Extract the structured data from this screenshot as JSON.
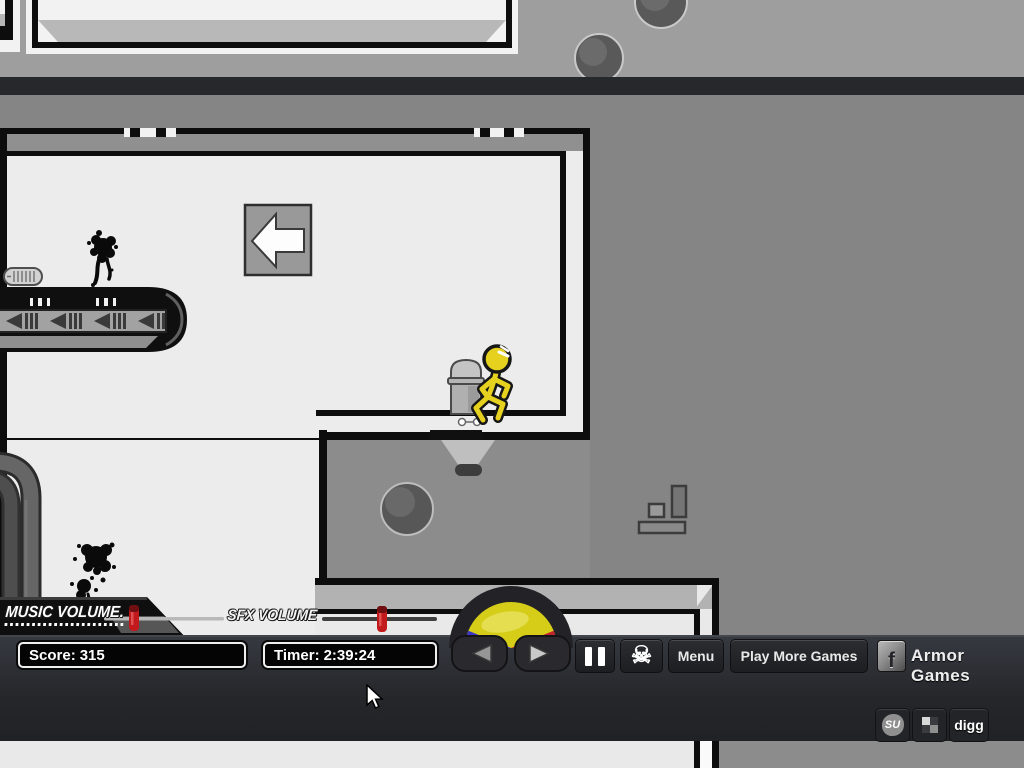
{
  "hud": {
    "score_label": "Score:",
    "score_value": "315",
    "timer_label": "Timer:",
    "timer_value": "2:39:24",
    "music_volume_label": "MUSIC VOLUME.",
    "sfx_volume_label": "SFX VOLUME",
    "music_volume_percent": 21,
    "sfx_volume_percent": 52,
    "pause_button_icon": "pause-bars",
    "suicide_button_icon": "skull-crossbones",
    "skull_glyph": "☠",
    "menu_button_label": "Menu",
    "play_more_games_label": "Play More Games",
    "facebook_icon_letter": "f",
    "armor_games_label": "Armor Games",
    "social": {
      "stumbleupon_label": "SU",
      "delicious_icon": "delicious-squares",
      "digg_label": "digg"
    },
    "colors": {
      "bar_background": "#2c2f33",
      "slider_knob_red": "#c2191c",
      "dpad_yellow": "#d6cd19",
      "dpad_blue": "#3a35c8",
      "dpad_red": "#c2242c"
    }
  },
  "game": {
    "background_gray": "#858585",
    "room_white": "#ececec",
    "character": "yellow-stickman-running",
    "character_color": "#e5d11e",
    "sign_arrow_direction": "left",
    "conveyor_arrow_direction": "left",
    "visible_objects": [
      "direction-sign",
      "conveyor-belt",
      "trash-can",
      "ceiling-light",
      "boulder",
      "step-blocks",
      "pipes",
      "wall-vent",
      "blood-splatter-upper",
      "blood-splatter-lower",
      "falling-balls"
    ]
  }
}
